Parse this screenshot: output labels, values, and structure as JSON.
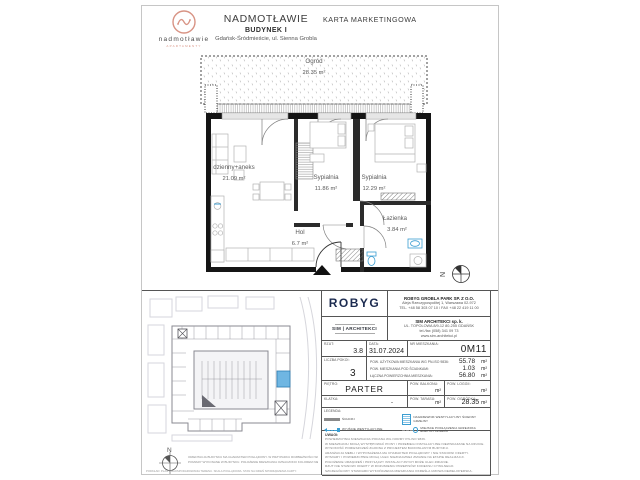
{
  "colors": {
    "accent": "#d89384",
    "plumbing_blue": "#3b9ed2",
    "robyg_navy": "#1c2b50",
    "highlight_unit": "#6fb6e2"
  },
  "header": {
    "logo_name": "nadmotławie",
    "logo_sub": "APARTAMENTY",
    "title": "NADMOTŁAWIE",
    "subtitle": "BUDYNEK I",
    "address": "Gdańsk-Śródmieście, ul. Sienna Grobla",
    "doc_type": "KARTA MARKETINGOWA"
  },
  "floorplan": {
    "garden": {
      "name": "Ogród",
      "area": "28.35 m²"
    },
    "rooms": {
      "living": {
        "name": "dzienny+aneks",
        "area": "21.09 m²"
      },
      "bedroom1": {
        "name": "Sypialnia",
        "area": "11.86 m²"
      },
      "bedroom2": {
        "name": "Sypialnia",
        "area": "12.29 m²"
      },
      "bathroom": {
        "name": "Łazienka",
        "area": "3.84 m²"
      },
      "hall": {
        "name": "Hol",
        "area": "6.7 m²"
      }
    },
    "compass": "N"
  },
  "siteplan": {
    "compass": "N",
    "notes": [
      "ORIENTACJA BUDYNKU MA CHARAKTER POGLĄDOWY. W PRZYPADKU ROZBIEŻNOŚCI WIĄŻĄCE POZOSTAJĄ",
      "POMIARY WYKONANE W BUDYNKU. POŁOŻENIE MIESZKANIA OZNACZONO KOLOREM NIEBIESKIM."
    ],
    "attribution": "PODKŁAD: PLAN ZAGOSPODAROWANIA TERENU. SKALA POGLĄDOWA. STAN NA DZIEŃ SPORZĄDZENIA KARTY."
  },
  "developer": {
    "name": "ROBYG",
    "company": "ROBYG GROBLA PARK SP. Z O.O.",
    "address": "Aleja Rzeczypospolitej 1, Warszawa 02-972",
    "phone": "TEL. +48 58 303 07 10 / FAX +48 22 419 11 00"
  },
  "architect": {
    "name": "SIM | ARCHITEKCI",
    "company": "SIM ARCHITEKCI sp. k.",
    "address": "UL. TOPOLOWA 8/9-12 80-255 GDAŃSK",
    "phone": "tel./fax (058) 341 09 73",
    "web": "www.sim-architekci.pl"
  },
  "table": {
    "rzut": {
      "label": "RZUT:",
      "value": "3.8"
    },
    "data": {
      "label": "DATA:",
      "value": "31.07.2024"
    },
    "nr": {
      "label": "NR MIESZKANIA:",
      "value": "0M11"
    },
    "pokoje": {
      "label": "LICZBA POKOI:",
      "value": "3"
    },
    "areas": [
      {
        "label": "POW. UŻYTKOWA MIESZKANIA WG PN-ISO 9836:",
        "value": "55.78",
        "unit": "m²"
      },
      {
        "label": "POW. MIESZKANIA POD ŚCIANKAMI:",
        "value": "1.03",
        "unit": "m²"
      },
      {
        "label": "ŁĄCZNA POWIERZCHNIA MIESZKANIA:",
        "value": "56.80",
        "unit": "m²"
      }
    ],
    "pietro": {
      "label": "PIĘTRO:",
      "value": "PARTER"
    },
    "balkon": {
      "label": "POW. BALKONU:",
      "value": "",
      "unit": "m²"
    },
    "loggia": {
      "label": "POW. LOGGII:",
      "value": "",
      "unit": "m²"
    },
    "klatka": {
      "label": "KLATKA:",
      "value": "-"
    },
    "taras": {
      "label": "POW. TARASU:",
      "value": "",
      "unit": "m²"
    },
    "ogrodek": {
      "label": "POW. OGRÓDKA:",
      "value": "28.35",
      "unit": "m²"
    }
  },
  "legend": {
    "title": "LEGENDA:",
    "items": [
      {
        "label": "ŚCIANKI"
      },
      {
        "label": "WYJŚCIE WENTYLACYJNE"
      },
      {
        "label": "NAGRZEWNIK WENTYLACYJNY ŚCIENNY GRZEJNY"
      },
      {
        "label": "MIEJSCE PODŁĄCZENIA GRZEJNIKA ELEKTRYCZNEGO"
      }
    ]
  },
  "uwagi": {
    "title": "UWAGI:",
    "lines": [
      "POWIERZCHNIA MIESZKANIA PODANA WG NORMY PN-ISO 9836.",
      "W MIESZKANIU MOGĄ WYSTĘPOWAĆ PIONY I PRZEBIEGI INSTALACYJNE NIEWSKAZANE NA RZUCIE.",
      "WYSOKOŚĆ POMIESZCZEŃ ZGODNA Z PROJEKTEM BUDOWLANYM BUDYNKU.",
      "ARANŻACJA MEBLI I WYPOSAŻENIA MA CHARAKTER POGLĄDOWY I NIE STANOWI OFERTY.",
      "WYMIARY I POWIERZCHNIE MOGĄ ULEC NIEZNACZNEJ ZMIANIE NA ETAPIE REALIZACJI.",
      "POŁOŻENIE URZĄDZEŃ I PRZYŁĄCZY INSTALACYJNYCH MOŻE ULEC ZMIANIE.",
      "RZUT NIE STANOWI OFERTY W ROZUMIENIU PRZEPISÓW KODEKSU CYWILNEGO.",
      "SZCZEGÓŁOWY STANDARD WYKOŃCZENIA MIESZKANIA OKREŚLA UMOWA DEWELOPERSKA."
    ]
  }
}
